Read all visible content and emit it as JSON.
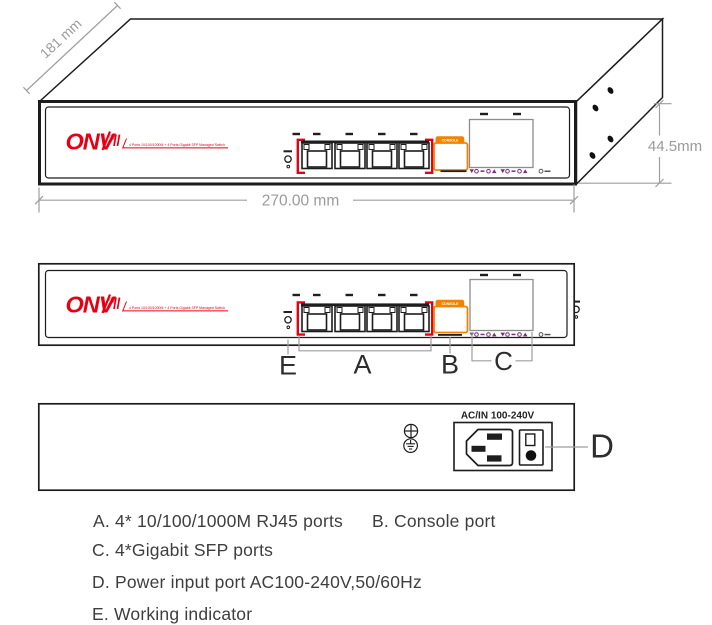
{
  "brand": {
    "name": "ONV",
    "registered": "®",
    "tagline": "4 Ports 10/100/1000M + 4 Ports Gigabit SFP Managed Switch"
  },
  "dimensions": {
    "depth": "181 mm",
    "width": "270.00 mm",
    "height": "44.5mm"
  },
  "front_panel": {
    "console_label": "CONSOLE"
  },
  "rear_panel": {
    "power_label": "AC/IN 100-240V"
  },
  "callouts": {
    "a": "A",
    "b": "B",
    "c": "C",
    "d": "D",
    "e": "E"
  },
  "legend": {
    "item_a": "A. 4* 10/100/1000M RJ45 ports",
    "item_b": "B. Console port",
    "item_c": "C. 4*Gigabit SFP ports",
    "item_d": "D. Power input port AC100-240V,50/60Hz",
    "item_e": "E. Working indicator"
  },
  "colors": {
    "brand_red": "#e60012",
    "console_orange": "#f08300",
    "sfp_purple": "#7b2c7f",
    "dimension_gray": "#9e9e9e",
    "outline_ink": "#1c1c1c",
    "legend_text": "#3e3e3e"
  }
}
